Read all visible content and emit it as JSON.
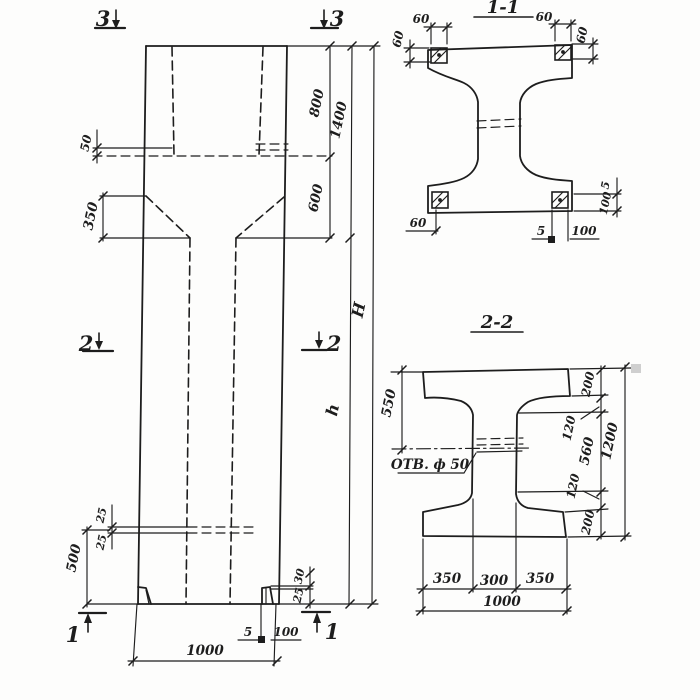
{
  "drawing": {
    "ink_color": "#1d1d1d",
    "background_color": "#fdfdfc",
    "elevation": {
      "marks": {
        "tl": "3",
        "tr": "3",
        "ml": "2",
        "mr": "2",
        "bl": "1",
        "br": "1"
      },
      "dims": {
        "recess_depth": "50",
        "haunch_height": "350",
        "embed_offset_upper": "25",
        "embed_offset_lower": "25",
        "embed_elevation": "500",
        "top_to_ledge": "800",
        "ledge_to_haunch": "600",
        "head_height": "1400",
        "shaft_height": "h",
        "total_height": "H",
        "foot_upper": "30",
        "foot_lower": "25",
        "base_plate_thk": "5",
        "base_plate_w": "100",
        "column_width": "1000"
      }
    },
    "section11": {
      "title": "1-1",
      "dims": {
        "plate_tl_w": "60",
        "plate_tl_h": "60",
        "plate_tr_w": "60",
        "plate_tr_h": "60",
        "plate_bl": "60",
        "plate_b_thk": "5",
        "plate_b_w": "100",
        "plate_r_thk": "5",
        "plate_r_w": "100"
      }
    },
    "section22": {
      "title": "2-2",
      "hole_label": "ОТВ. ф 50",
      "dims": {
        "flange_to_hole": "550",
        "flange_top": "200",
        "haunch_top": "120",
        "web_clear": "560",
        "haunch_bot": "120",
        "flange_bot": "200",
        "overall_depth": "1200",
        "flange_left": "350",
        "web_width": "300",
        "flange_right": "350",
        "overall_width": "1000"
      }
    }
  }
}
